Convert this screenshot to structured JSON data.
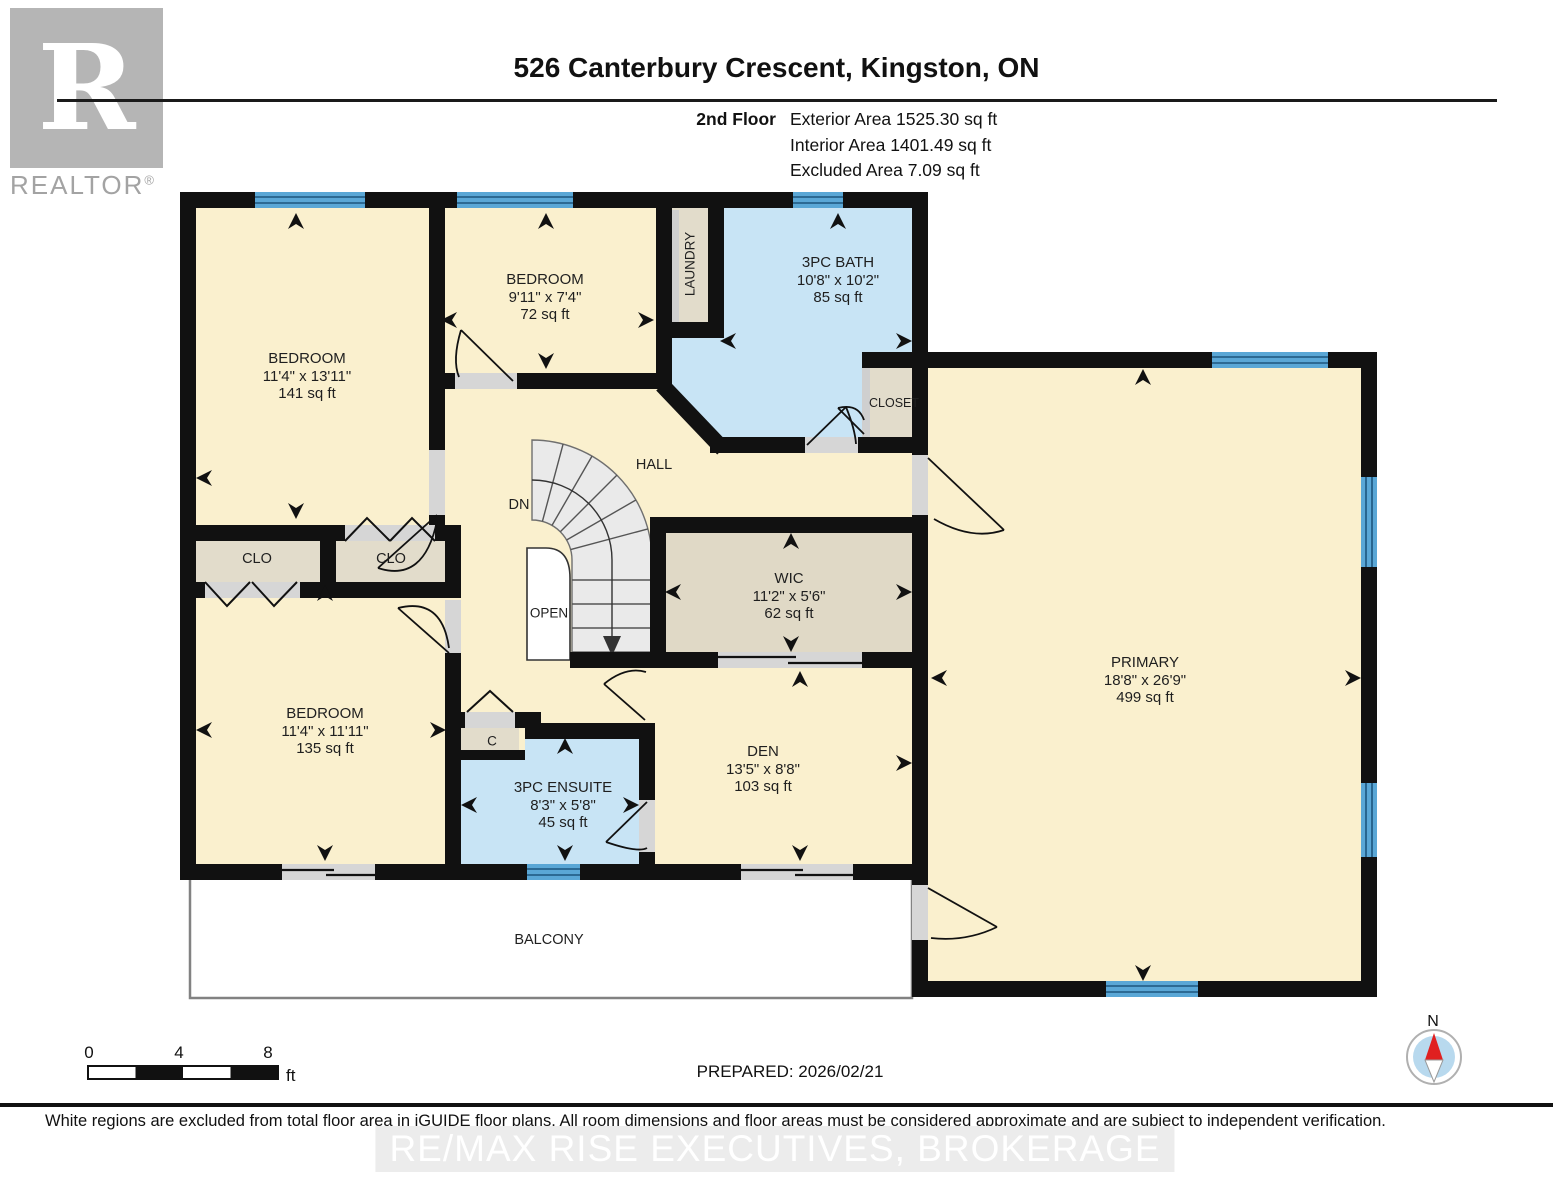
{
  "header": {
    "title": "526 Canterbury Crescent, Kingston, ON",
    "floor": "2nd Floor",
    "exterior_area": "Exterior Area 1525.30 sq ft",
    "interior_area": "Interior Area 1401.49 sq ft",
    "excluded_area": "Excluded Area 7.09 sq ft"
  },
  "brand": {
    "logo_letter": "R",
    "logo_text": "REALTOR",
    "registered": "®"
  },
  "rooms": {
    "bedroom_top_left": {
      "name": "BEDROOM",
      "dims": "11'4\" x 13'11\"",
      "area": "141 sq ft"
    },
    "bedroom_top_mid": {
      "name": "BEDROOM",
      "dims": "9'11\" x 7'4\"",
      "area": "72 sq ft"
    },
    "bath": {
      "name": "3PC BATH",
      "dims": "10'8\" x 10'2\"",
      "area": "85 sq ft"
    },
    "wic": {
      "name": "WIC",
      "dims": "11'2\" x 5'6\"",
      "area": "62 sq ft"
    },
    "bedroom_bottom": {
      "name": "BEDROOM",
      "dims": "11'4\" x 11'11\"",
      "area": "135 sq ft"
    },
    "ensuite": {
      "name": "3PC ENSUITE",
      "dims": "8'3\" x 5'8\"",
      "area": "45 sq ft"
    },
    "den": {
      "name": "DEN",
      "dims": "13'5\" x 8'8\"",
      "area": "103 sq ft"
    },
    "primary": {
      "name": "PRIMARY",
      "dims": "18'8\" x 26'9\"",
      "area": "499 sq ft"
    }
  },
  "labels": {
    "hall": "HALL",
    "dn": "DN",
    "open": "OPEN",
    "clo": "CLO",
    "c": "C",
    "closet": "CLOSET",
    "laundry": "LAUNDRY",
    "balcony": "BALCONY"
  },
  "footer": {
    "scale_0": "0",
    "scale_4": "4",
    "scale_8": "8",
    "scale_unit": "ft",
    "prepared": "PREPARED: 2026/02/21",
    "compass_n": "N",
    "disclaimer": "White regions are excluded from total floor area in iGUIDE floor plans. All room dimensions and floor areas must be considered approximate and are subject to independent verification.",
    "watermark": "RE/MAX RISE EXECUTIVES, BROKERAGE"
  },
  "colors": {
    "wall": "#111111",
    "room_cream": "#FAF0CE",
    "wet_blue": "#C8E4F5",
    "closet_tan": "#E2DCCB",
    "wic_tan": "#E0D9C6",
    "window_blue": "#5AA7D6",
    "door_gray": "#D6D6D6",
    "balcony_white": "#FFFFFF"
  }
}
